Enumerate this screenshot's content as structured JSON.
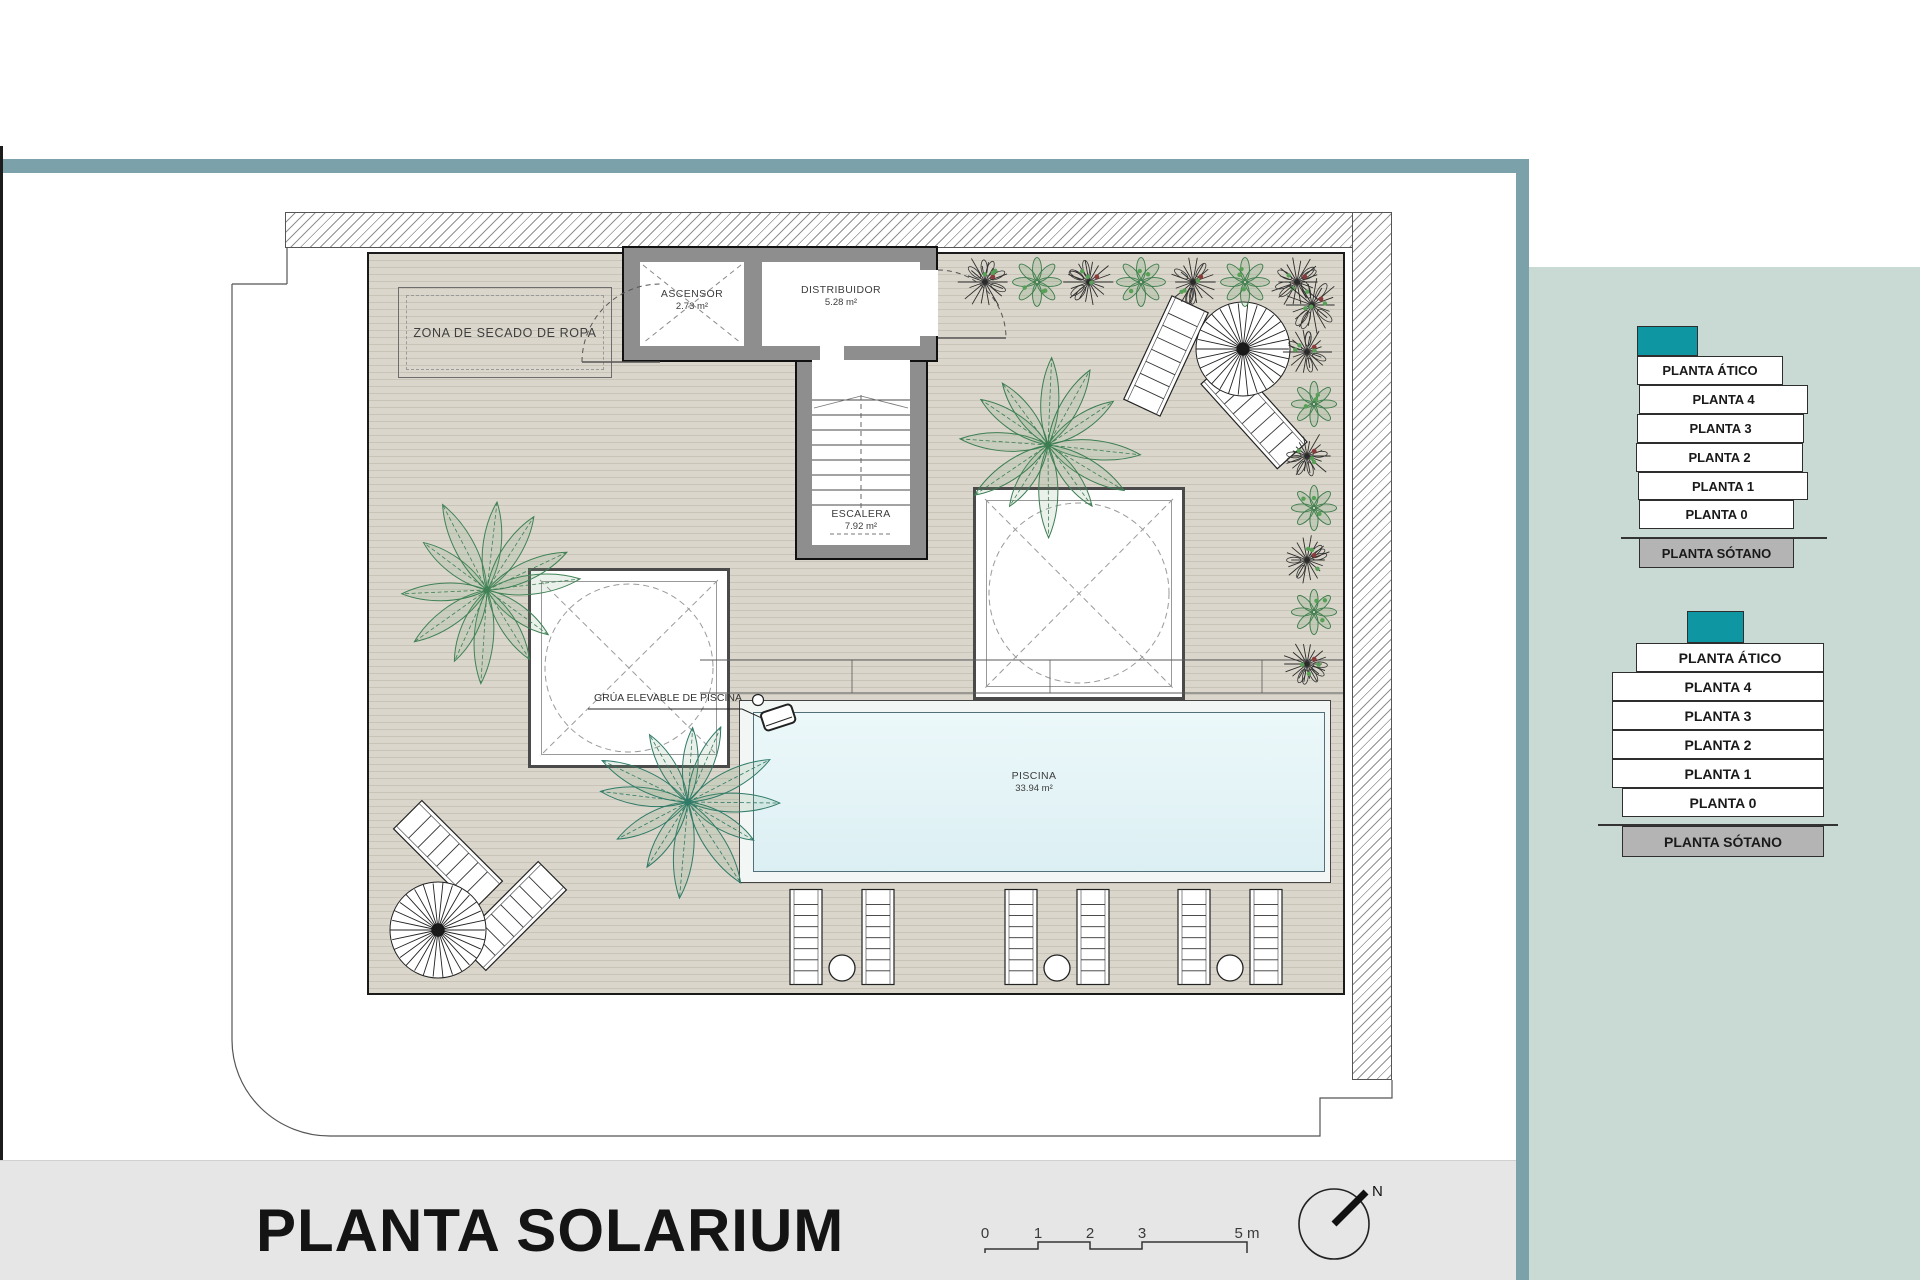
{
  "plan": {
    "title": "PLANTA SOLARIUM",
    "labels": {
      "drying_zone": "ZONA DE SECADO DE ROPA",
      "pool_hoist": "GRÚA ELEVABLE DE PISCINA"
    },
    "rooms": {
      "ascensor": {
        "name": "ASCENSOR",
        "area": "2.73 m²"
      },
      "distribuidor": {
        "name": "DISTRIBUIDOR",
        "area": "5.28 m²"
      },
      "escalera": {
        "name": "ESCALERA",
        "area": "7.92 m²"
      },
      "piscina": {
        "name": "PISCINA",
        "area": "33.94 m²"
      }
    },
    "north_label": "N",
    "scale_bar": {
      "ticks": [
        "0",
        "1",
        "2",
        "3"
      ],
      "end_label": "5 m"
    }
  },
  "sidebar": {
    "stacks": [
      {
        "levels": [
          "PLANTA ÁTICO",
          "PLANTA 4",
          "PLANTA 3",
          "PLANTA 2",
          "PLANTA 1",
          "PLANTA 0",
          "PLANTA SÓTANO"
        ]
      },
      {
        "levels": [
          "PLANTA ÁTICO",
          "PLANTA 4",
          "PLANTA 3",
          "PLANTA 2",
          "PLANTA 1",
          "PLANTA 0",
          "PLANTA SÓTANO"
        ]
      }
    ]
  },
  "colors": {
    "accent_teal": "#0e96a2",
    "frame_teal": "#7ba1aa",
    "sidebar_bg": "#c8dad3",
    "basement_gray": "#b4b4b4",
    "pool_water": "#dceff3",
    "deck_gray": "#d9d5ca",
    "footer_gray": "#e6e6e6"
  }
}
